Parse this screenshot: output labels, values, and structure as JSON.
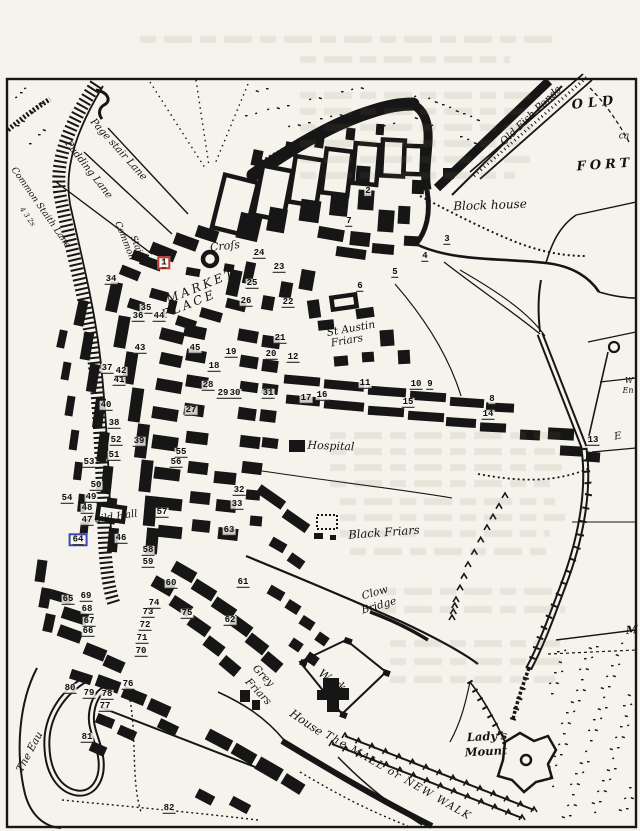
{
  "title": "INNS TAVERNS AND ALEHOUSES IN KING'S LYNN, 1764",
  "colors": {
    "paper": "#f5f3ec",
    "ink": "#161616",
    "highlight_red": "#c33a34",
    "highlight_blue": "#3a49b5"
  },
  "map": {
    "region_labels": [
      {
        "id": "page-stair-lane",
        "text": "Page stair Lane",
        "x": 118,
        "y": 150,
        "rot": 48,
        "size": 10
      },
      {
        "id": "pudding-lane",
        "text": "Pudding Lane",
        "x": 88,
        "y": 170,
        "rot": 52,
        "size": 10
      },
      {
        "id": "common-staith-lane",
        "text": "Common Staith Lane",
        "x": 40,
        "y": 208,
        "rot": 55,
        "size": 9
      },
      {
        "id": "quay-numbers",
        "text": "4 3 2s",
        "x": 27,
        "y": 217,
        "rot": 55,
        "size": 7
      },
      {
        "id": "common-staith-1",
        "text": "Common",
        "x": 124,
        "y": 241,
        "rot": 68,
        "size": 9
      },
      {
        "id": "common-staith-2",
        "text": "Staith",
        "x": 137,
        "y": 249,
        "rot": 68,
        "size": 9
      },
      {
        "id": "cross",
        "text": "Croſs",
        "x": 225,
        "y": 246,
        "rot": -6,
        "size": 11
      },
      {
        "id": "market",
        "text": "MARKET",
        "x": 201,
        "y": 286,
        "rot": -22,
        "size": 12,
        "ls": 3
      },
      {
        "id": "place",
        "text": "PLACE",
        "x": 189,
        "y": 304,
        "rot": -22,
        "size": 12,
        "ls": 3
      },
      {
        "id": "st-austin",
        "text": "St Austin",
        "x": 351,
        "y": 329,
        "rot": -10,
        "size": 10.5
      },
      {
        "id": "st-austin-friars",
        "text": "Friars",
        "x": 347,
        "y": 341,
        "rot": -10,
        "size": 10.5
      },
      {
        "id": "old-fish-ponds",
        "text": "Old Fish Ponds",
        "x": 531,
        "y": 116,
        "rot": -44,
        "size": 10.5
      },
      {
        "id": "old",
        "text": "OLD",
        "x": 595,
        "y": 103,
        "rot": -6,
        "size": 13,
        "ls": 5,
        "bold": 1
      },
      {
        "id": "ca-fragment",
        "text": "ca",
        "x": 624,
        "y": 137,
        "rot": 0,
        "size": 9
      },
      {
        "id": "fort",
        "text": "FORT",
        "x": 605,
        "y": 165,
        "rot": -4,
        "size": 13,
        "ls": 4,
        "bold": 1
      },
      {
        "id": "blockhouse",
        "text": "Block house",
        "x": 490,
        "y": 205,
        "rot": -2,
        "size": 12
      },
      {
        "id": "hospital",
        "text": "Hospital",
        "x": 331,
        "y": 446,
        "rot": 2,
        "size": 11
      },
      {
        "id": "black-friars",
        "text": "Black Friars",
        "x": 384,
        "y": 533,
        "rot": -4,
        "size": 11.5
      },
      {
        "id": "clow",
        "text": "Clow",
        "x": 375,
        "y": 593,
        "rot": -16,
        "size": 10.5
      },
      {
        "id": "clow-bridge",
        "text": "Bridge",
        "x": 379,
        "y": 606,
        "rot": -16,
        "size": 10.5
      },
      {
        "id": "grey",
        "text": "Grey",
        "x": 263,
        "y": 676,
        "rot": 46,
        "size": 10.5
      },
      {
        "id": "grey-friars",
        "text": "Friars",
        "x": 258,
        "y": 692,
        "rot": 46,
        "size": 10.5
      },
      {
        "id": "work",
        "text": "Work",
        "x": 332,
        "y": 681,
        "rot": 34,
        "size": 11.5
      },
      {
        "id": "work-house",
        "text": "House",
        "x": 306,
        "y": 723,
        "rot": 34,
        "size": 11.5
      },
      {
        "id": "the-mall",
        "text": "The MALL or NEW WALK",
        "x": 398,
        "y": 776,
        "rot": 30,
        "size": 10.5,
        "ls": 1.5
      },
      {
        "id": "ladys",
        "text": "Lady's",
        "x": 487,
        "y": 737,
        "rot": -3,
        "size": 11.5,
        "bold": 1
      },
      {
        "id": "mount",
        "text": "Mount",
        "x": 486,
        "y": 752,
        "rot": -3,
        "size": 11.5,
        "bold": 1
      },
      {
        "id": "the-eau",
        "text": "The Eau",
        "x": 30,
        "y": 752,
        "rot": -62,
        "size": 10.5
      },
      {
        "id": "guild-hall",
        "text": "Guild Hall",
        "x": 112,
        "y": 518,
        "rot": -8,
        "size": 10
      },
      {
        "id": "edge-w",
        "text": "W",
        "x": 629,
        "y": 381,
        "rot": 0,
        "size": 8
      },
      {
        "id": "edge-en",
        "text": "En",
        "x": 628,
        "y": 391,
        "rot": 0,
        "size": 8
      },
      {
        "id": "edge-e",
        "text": "E",
        "x": 618,
        "y": 437,
        "rot": -10,
        "size": 10
      },
      {
        "id": "edge-m",
        "text": "M",
        "x": 632,
        "y": 630,
        "rot": -5,
        "size": 11,
        "bold": 1
      }
    ],
    "numbers": [
      {
        "n": "1",
        "x": 164,
        "y": 263,
        "box": "red"
      },
      {
        "n": "2",
        "x": 368,
        "y": 192
      },
      {
        "n": "3",
        "x": 447,
        "y": 240
      },
      {
        "n": "4",
        "x": 425,
        "y": 257
      },
      {
        "n": "5",
        "x": 395,
        "y": 273
      },
      {
        "n": "6",
        "x": 360,
        "y": 287
      },
      {
        "n": "7",
        "x": 349,
        "y": 222
      },
      {
        "n": "8",
        "x": 492,
        "y": 400
      },
      {
        "n": "9",
        "x": 430,
        "y": 385
      },
      {
        "n": "10",
        "x": 416,
        "y": 385
      },
      {
        "n": "11",
        "x": 365,
        "y": 384
      },
      {
        "n": "12",
        "x": 293,
        "y": 358
      },
      {
        "n": "13",
        "x": 593,
        "y": 441
      },
      {
        "n": "14",
        "x": 488,
        "y": 415
      },
      {
        "n": "15",
        "x": 408,
        "y": 403
      },
      {
        "n": "16",
        "x": 322,
        "y": 396
      },
      {
        "n": "17",
        "x": 306,
        "y": 399
      },
      {
        "n": "18",
        "x": 214,
        "y": 367
      },
      {
        "n": "19",
        "x": 231,
        "y": 353
      },
      {
        "n": "20",
        "x": 271,
        "y": 355
      },
      {
        "n": "21",
        "x": 280,
        "y": 339
      },
      {
        "n": "22",
        "x": 288,
        "y": 303
      },
      {
        "n": "23",
        "x": 279,
        "y": 268
      },
      {
        "n": "24",
        "x": 259,
        "y": 254
      },
      {
        "n": "25",
        "x": 252,
        "y": 284
      },
      {
        "n": "26",
        "x": 246,
        "y": 302
      },
      {
        "n": "27",
        "x": 191,
        "y": 411
      },
      {
        "n": "28",
        "x": 208,
        "y": 386
      },
      {
        "n": "29",
        "x": 223,
        "y": 394
      },
      {
        "n": "30",
        "x": 235,
        "y": 394
      },
      {
        "n": "31",
        "x": 268,
        "y": 394
      },
      {
        "n": "32",
        "x": 239,
        "y": 491
      },
      {
        "n": "33",
        "x": 237,
        "y": 505
      },
      {
        "n": "34",
        "x": 111,
        "y": 280
      },
      {
        "n": "35",
        "x": 146,
        "y": 309
      },
      {
        "n": "36",
        "x": 138,
        "y": 317
      },
      {
        "n": "37",
        "x": 107,
        "y": 369
      },
      {
        "n": "38",
        "x": 114,
        "y": 424
      },
      {
        "n": "39",
        "x": 139,
        "y": 442
      },
      {
        "n": "40",
        "x": 106,
        "y": 406
      },
      {
        "n": "41",
        "x": 119,
        "y": 381
      },
      {
        "n": "42",
        "x": 121,
        "y": 372
      },
      {
        "n": "43",
        "x": 140,
        "y": 349
      },
      {
        "n": "44",
        "x": 159,
        "y": 317
      },
      {
        "n": "45",
        "x": 195,
        "y": 349
      },
      {
        "n": "46",
        "x": 121,
        "y": 539
      },
      {
        "n": "47",
        "x": 87,
        "y": 521
      },
      {
        "n": "48",
        "x": 87,
        "y": 509
      },
      {
        "n": "49",
        "x": 91,
        "y": 498
      },
      {
        "n": "50",
        "x": 96,
        "y": 486
      },
      {
        "n": "51",
        "x": 114,
        "y": 456
      },
      {
        "n": "52",
        "x": 116,
        "y": 441
      },
      {
        "n": "53",
        "x": 89,
        "y": 463
      },
      {
        "n": "54",
        "x": 67,
        "y": 499
      },
      {
        "n": "55",
        "x": 181,
        "y": 453
      },
      {
        "n": "56",
        "x": 176,
        "y": 463
      },
      {
        "n": "57",
        "x": 162,
        "y": 513
      },
      {
        "n": "58",
        "x": 148,
        "y": 551
      },
      {
        "n": "59",
        "x": 148,
        "y": 563
      },
      {
        "n": "60",
        "x": 171,
        "y": 584
      },
      {
        "n": "61",
        "x": 243,
        "y": 583
      },
      {
        "n": "62",
        "x": 230,
        "y": 621
      },
      {
        "n": "63",
        "x": 229,
        "y": 531
      },
      {
        "n": "64",
        "x": 78,
        "y": 540,
        "box": "blue"
      },
      {
        "n": "65",
        "x": 68,
        "y": 600
      },
      {
        "n": "66",
        "x": 88,
        "y": 632
      },
      {
        "n": "67",
        "x": 89,
        "y": 622
      },
      {
        "n": "68",
        "x": 87,
        "y": 610
      },
      {
        "n": "69",
        "x": 86,
        "y": 597
      },
      {
        "n": "70",
        "x": 141,
        "y": 652
      },
      {
        "n": "71",
        "x": 142,
        "y": 639
      },
      {
        "n": "72",
        "x": 145,
        "y": 626
      },
      {
        "n": "73",
        "x": 148,
        "y": 613
      },
      {
        "n": "74",
        "x": 154,
        "y": 604
      },
      {
        "n": "75",
        "x": 187,
        "y": 614
      },
      {
        "n": "76",
        "x": 128,
        "y": 685
      },
      {
        "n": "77",
        "x": 105,
        "y": 707
      },
      {
        "n": "78",
        "x": 107,
        "y": 695
      },
      {
        "n": "79",
        "x": 89,
        "y": 694
      },
      {
        "n": "80",
        "x": 70,
        "y": 689
      },
      {
        "n": "81",
        "x": 87,
        "y": 738
      },
      {
        "n": "82",
        "x": 169,
        "y": 809
      }
    ]
  }
}
